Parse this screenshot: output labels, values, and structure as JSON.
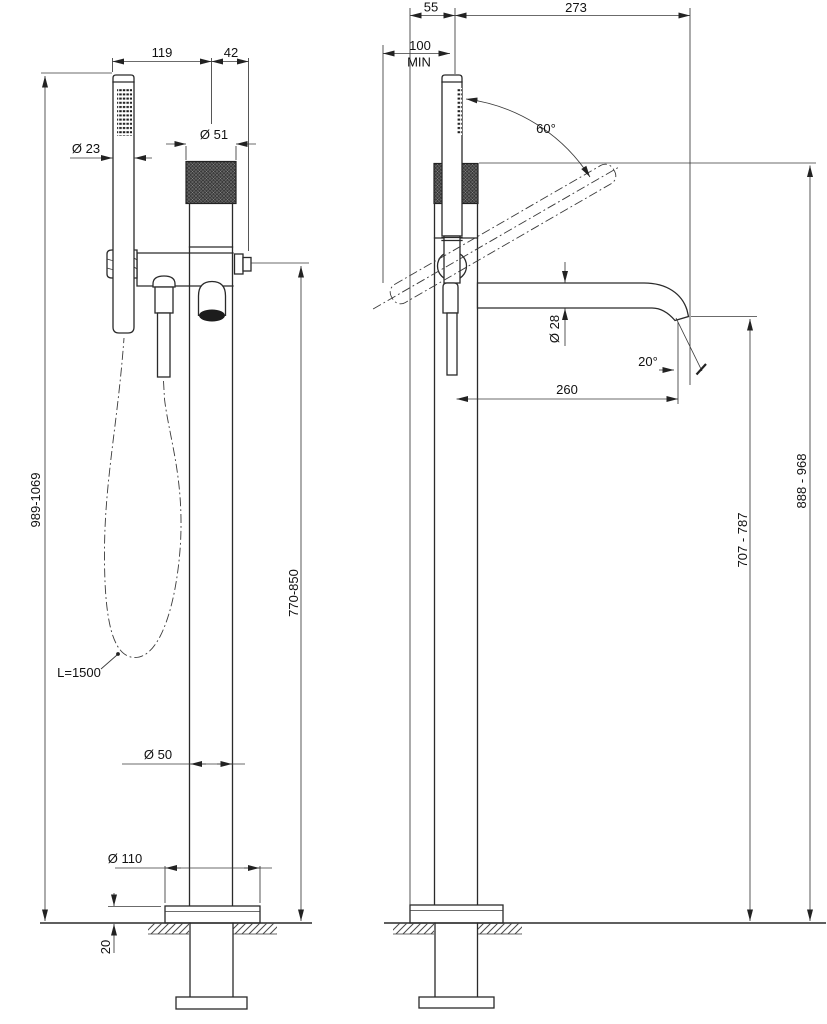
{
  "drawing": {
    "kind": "technical dimensional drawing",
    "subject": "floor-mounted bath mixer column with hand shower and spout"
  },
  "front_view": {
    "handshower_to_column": "119",
    "column_to_port": "42",
    "handshower_diameter": "Ø 23",
    "knob_diameter": "Ø 51",
    "height_range": "989-1069",
    "outlet_height_range": "770-850",
    "hose_length": "L=1500",
    "column_diameter": "Ø 50",
    "base_diameter": "Ø 110",
    "base_plate_height": "20"
  },
  "side_view": {
    "front_offset": "55",
    "spout_overall_reach": "273",
    "min_clearance": "100",
    "min_label": "MIN",
    "swivel_angle": "60°",
    "spout_diameter": "Ø 28",
    "spout_reach": "260",
    "outlet_angle": "20°",
    "outlet_height_range": "707 - 787",
    "body_height_range": "888 - 968"
  }
}
